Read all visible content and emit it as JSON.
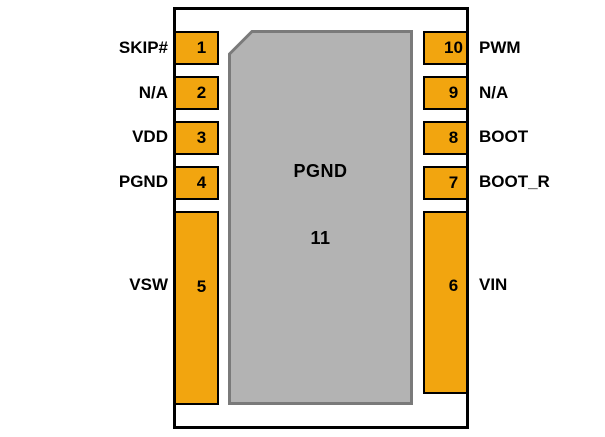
{
  "diagram": {
    "kind": "ic-package-pinout",
    "center_pad": {
      "label": "PGND",
      "number": "11"
    },
    "pins": {
      "left": [
        {
          "number": "1",
          "label": "SKIP#"
        },
        {
          "number": "2",
          "label": "N/A"
        },
        {
          "number": "3",
          "label": "VDD"
        },
        {
          "number": "4",
          "label": "PGND"
        },
        {
          "number": "5",
          "label": "VSW"
        }
      ],
      "right": [
        {
          "number": "10",
          "label": "PWM"
        },
        {
          "number": "9",
          "label": "N/A"
        },
        {
          "number": "8",
          "label": "BOOT"
        },
        {
          "number": "7",
          "label": "BOOT_R"
        },
        {
          "number": "6",
          "label": "VIN"
        }
      ]
    },
    "colors": {
      "pin_fill": "#F2A50F",
      "pin_border": "#000000",
      "pad_fill": "#B3B3B3",
      "pad_border": "#7A7A7A",
      "outline": "#000000",
      "background": "#FFFFFF",
      "text": "#000000"
    }
  }
}
